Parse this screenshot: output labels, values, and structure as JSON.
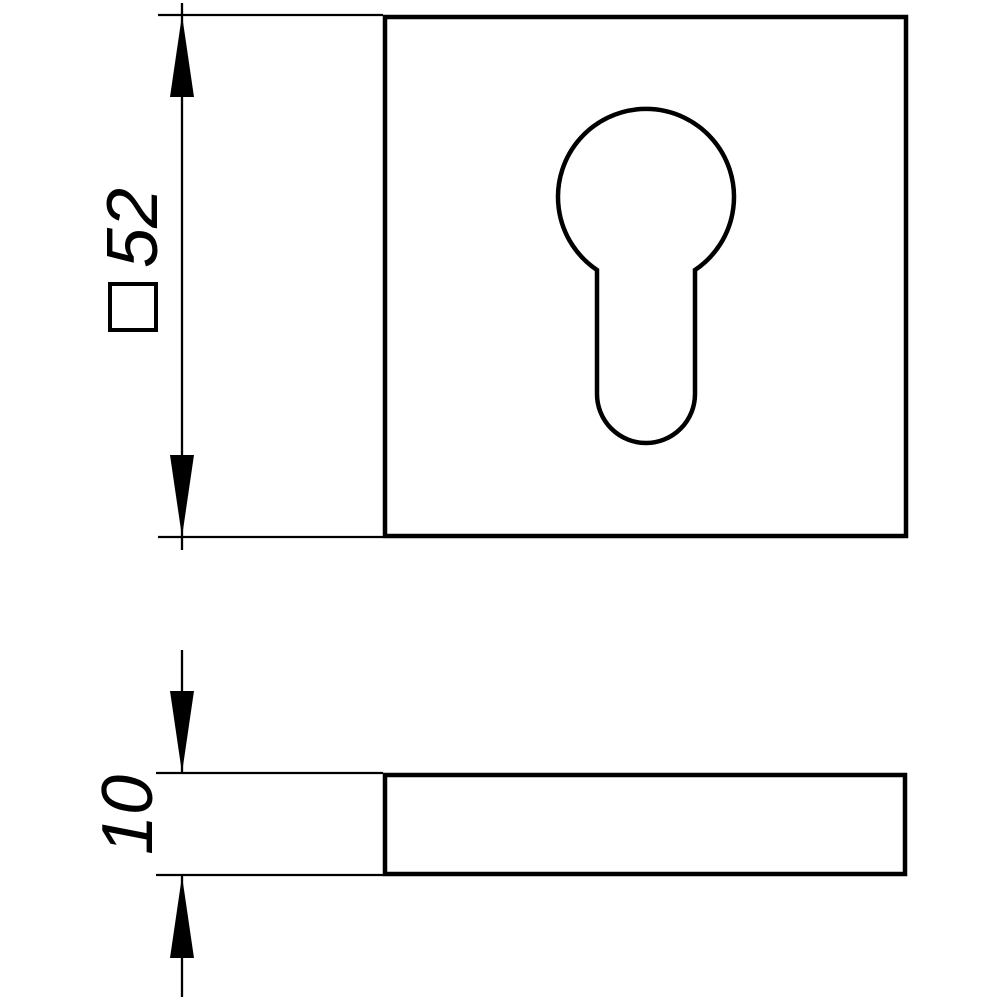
{
  "drawing": {
    "kind": "technical-dimension-drawing",
    "subject": "square escutcheon plate with euro cylinder keyhole cutout",
    "views": [
      {
        "id": "plan",
        "description": "front view: square plate with keyhole-shaped cylinder cutout"
      },
      {
        "id": "side",
        "description": "side view: thin horizontal plate section"
      }
    ]
  },
  "dimensions": {
    "width": {
      "value": "52",
      "symbol": "□",
      "reading": "square 52"
    },
    "thickness": {
      "value": "10"
    }
  },
  "colors": {
    "line": "#000000",
    "background": "#ffffff"
  }
}
